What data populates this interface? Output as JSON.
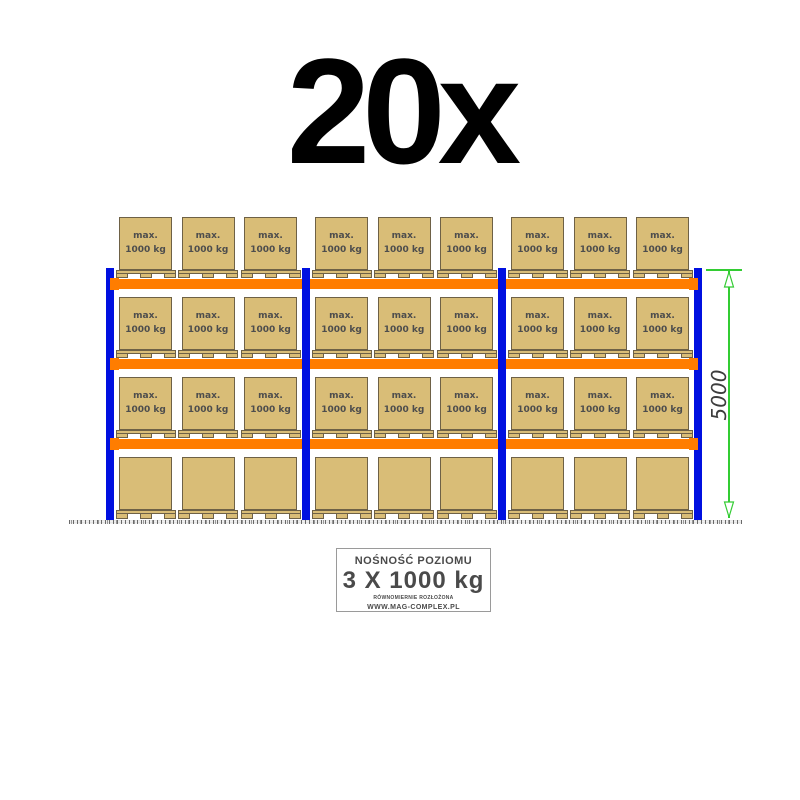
{
  "header": {
    "quantity_label": "20x"
  },
  "rack": {
    "bay_count": 3,
    "level_count": 4,
    "pallets_per_bay": 3,
    "labeled_level_count": 3,
    "box_label_line1": "max.",
    "box_label_line2": "1000 kg"
  },
  "dimension": {
    "height_label": "5000"
  },
  "info_panel": {
    "title": "NOŚNOŚĆ POZIOMU",
    "capacity": "3 X 1000 kg",
    "note": "RÓWNOMIERNIE ROZŁOŻONA",
    "website": "WWW.MAG-COMPLEX.PL"
  },
  "colors": {
    "post_blue": "#0010e0",
    "beam_orange": "#ff7d00",
    "box_tan": "#d9bd77",
    "box_border": "#6e6146",
    "dimension_green": "#33cc33",
    "text_gray": "#4d4d4d"
  }
}
